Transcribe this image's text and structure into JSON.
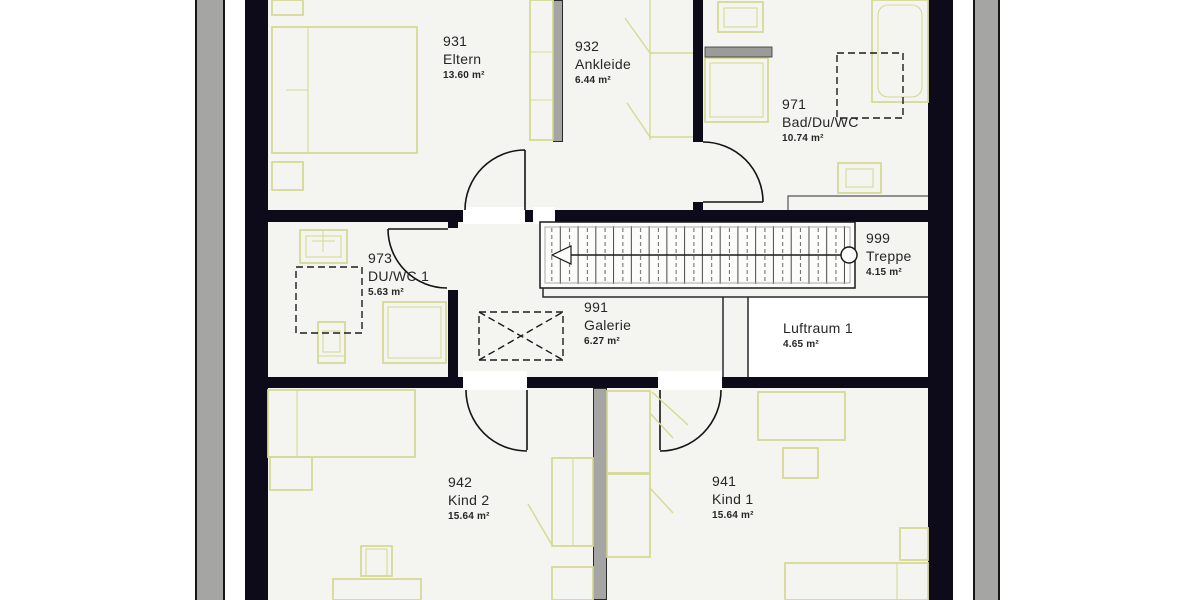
{
  "plan_title": "Obergeschoss Grundriss",
  "rooms": [
    {
      "number": "931",
      "name": "Eltern",
      "area": "13.60 m²"
    },
    {
      "number": "932",
      "name": "Ankleide",
      "area": "6.44 m²"
    },
    {
      "number": "971",
      "name": "Bad/Du/WC",
      "area": "10.74 m²"
    },
    {
      "number": "973",
      "name": "DU/WC 1",
      "area": "5.63 m²"
    },
    {
      "number": "999",
      "name": "Treppe",
      "area": "4.15 m²"
    },
    {
      "number": "991",
      "name": "Galerie",
      "area": "6.27 m²"
    },
    {
      "number": "",
      "name": "Luftraum 1",
      "area": "4.65 m²"
    },
    {
      "number": "942",
      "name": "Kind 2",
      "area": "15.64 m²"
    },
    {
      "number": "941",
      "name": "Kind 1",
      "area": "15.64 m²"
    }
  ],
  "colors": {
    "wall": "#0d0a1a",
    "floor": "#f4f4f0",
    "roof_strip": "#a5a5a3",
    "furniture": "#d6da96",
    "line": "#141414",
    "text": "#262626"
  }
}
